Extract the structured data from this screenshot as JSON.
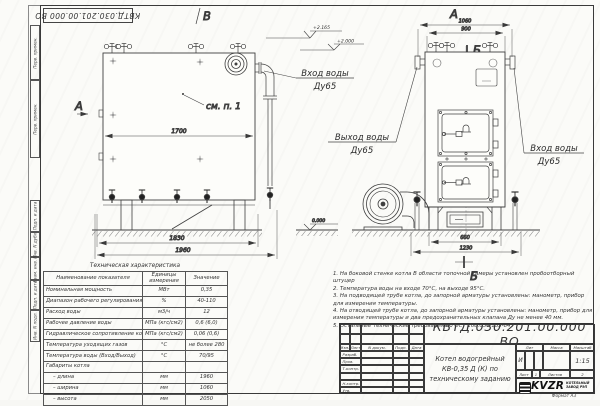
{
  "frame": {
    "margin_box_1": "Перв. примен.",
    "margin_box_2": "Перв. примен.",
    "margin_box_3": "Подп. и дата",
    "margin_box_4": "Инв. N дубл.",
    "margin_box_5": "Взам. инв. N",
    "margin_box_6": "Подп. и дата",
    "margin_box_7": "Инв. N подл.",
    "format_note": "Формат  А3"
  },
  "front_view": {
    "view_letter_top": "В",
    "view_letter_side": "А",
    "see_note": "см. п. 1",
    "dim_1700": "1700",
    "dim_1830": "1830",
    "dim_1960": "1960",
    "elev_zero": "0.000"
  },
  "side_view": {
    "view_letter": "А",
    "section_letter_top": "Б",
    "section_letter_bottom": "Б",
    "dim_1060": "1060",
    "dim_900": "900",
    "dim_660": "660",
    "dim_1230": "1230",
    "elev_1": "+2.165",
    "elev_2": "+2.000"
  },
  "pipe_labels": {
    "inlet_top_line1": "Вход воды",
    "inlet_top_line2": "Ду65",
    "outlet_line1": "Выход воды",
    "outlet_line2": "Ду65",
    "inlet_right_line1": "Вход воды",
    "inlet_right_line2": "Ду65"
  },
  "spec_table": {
    "title": "Техническая характеристика",
    "col_name": "Наименование показателя",
    "col_unit": "Единицы измерения",
    "col_value": "Значение",
    "rows": [
      {
        "name": "Номинальная мощность",
        "unit": "МВт",
        "value": "0,35"
      },
      {
        "name": "Диапазон рабочего регулирования",
        "unit": "%",
        "value": "40-110"
      },
      {
        "name": "Расход воды",
        "unit": "м3/ч",
        "value": "12"
      },
      {
        "name": "Рабочее давление воды",
        "unit": "МПа (кгс/см2)",
        "value": "0,6 (6,0)"
      },
      {
        "name": "Гидравлическое сопротивление котла",
        "unit": "МПа (кгс/см2)",
        "value": "0,06 (0,6)"
      },
      {
        "name": "Температура уходящих газов",
        "unit": "°С",
        "value": "не более 280"
      },
      {
        "name": "Температура воды (Вход/Выход)",
        "unit": "°С",
        "value": "70/95"
      },
      {
        "name": "Габариты котла",
        "unit": "",
        "value": ""
      },
      {
        "name": "– длина",
        "unit": "мм",
        "value": "1960"
      },
      {
        "name": "– ширина",
        "unit": "мм",
        "value": "1060"
      },
      {
        "name": "– высота",
        "unit": "мм",
        "value": "2050"
      }
    ]
  },
  "notes": [
    "1.  На боковой стенке котла В области топочной камеры установлен пробоотборный штуцер",
    "2.  Температура воды на входе 70°С, на выходе 95°С.",
    "3.  На подводящей трубе котла, до запорной арматуры установлены: манометр, прибор для измерения температуры.",
    "4.  На отводящей трубе котла, до запорной арматуры установлены: манометр, прибор для измерения температуры и два предохранительных клапана Ду не менее 40 мм.",
    "5.  Остальные технические требования по ОСТ 108.030.133-84."
  ],
  "title_block": {
    "doc_number": "КВТД.030.201.00.000  ВО",
    "product_line1": "Котел водогрейный",
    "product_line2": "КВ-0,35 Д (К) по",
    "product_line3": "техническому заданию",
    "col_izm": "Изм.",
    "col_list": "Лист",
    "col_doc": "N докум.",
    "col_podp": "Подп.",
    "col_data": "Дата",
    "row_razrab": "Разраб.",
    "row_prov": "Пров.",
    "row_tkontr": "Т.контр.",
    "row_nkontr": "Н.контр.",
    "row_utv": "Утв.",
    "lit_label": "Лит",
    "mass_label": "Масса",
    "scale_label": "Масштаб",
    "lit_value": "И",
    "scale_value": "1:15",
    "sheet_label": "Лист",
    "sheet_num": "1",
    "sheets_label": "Листов",
    "sheets_num": "2",
    "logo_word": "KVZR",
    "logo_sub1": "КОТЕЛЬНЫЙ",
    "logo_sub2": "ЗАВОД РЭП"
  }
}
